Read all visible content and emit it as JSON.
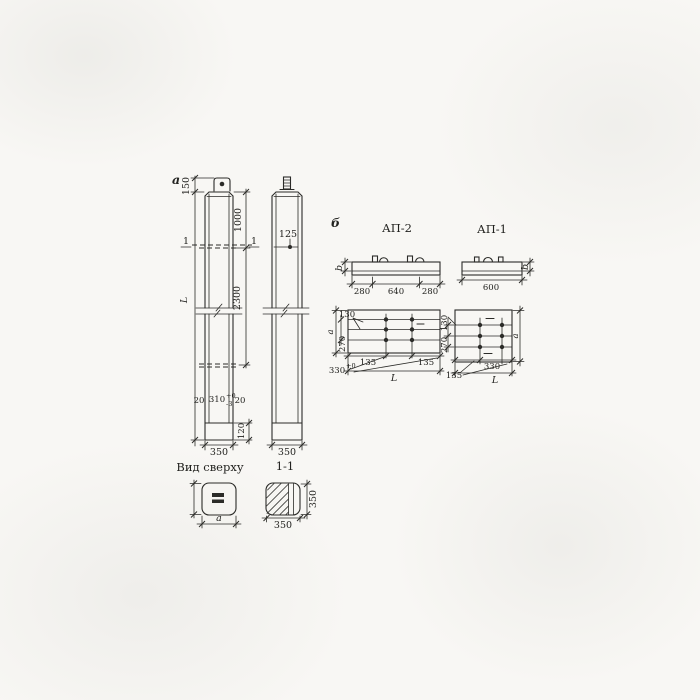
{
  "page": {
    "background": "#f8f7f4",
    "ink": "#2b2b28"
  },
  "front_view": {
    "label": "а",
    "dims": {
      "d150": "150",
      "d1000": "1000",
      "d2300": "2300",
      "dL": "L",
      "d20l": "20",
      "d310": "310",
      "d310_sup": "+0",
      "d310_sub": "-3",
      "d20r": "20",
      "d120": "120",
      "d350": "350"
    },
    "section_marks": {
      "left": "1",
      "right": "1"
    }
  },
  "side_view": {
    "dims": {
      "d125": "125",
      "d350": "350"
    }
  },
  "top_view": {
    "title": "Вид сверху",
    "dims": {
      "da": "a"
    }
  },
  "section_view": {
    "title": "1-1",
    "dims": {
      "d350v": "350",
      "d350h": "350"
    }
  },
  "group_b_label": "б",
  "ap2": {
    "title": "АП-2",
    "elevation": {
      "db": "b",
      "d280l": "280",
      "d640": "640",
      "d280r": "280"
    },
    "plan": {
      "d130": "130",
      "da": "a",
      "d270": "270",
      "d135l": "135",
      "d135r": "135",
      "d330": "330",
      "d330_sup": "+0",
      "dL": "L"
    }
  },
  "ap1": {
    "title": "АП-1",
    "elevation": {
      "d600": "600",
      "db": "b"
    },
    "plan": {
      "d130": "130",
      "d270": "270",
      "da": "a",
      "d330": "330",
      "d135": "135",
      "dL": "L"
    }
  }
}
